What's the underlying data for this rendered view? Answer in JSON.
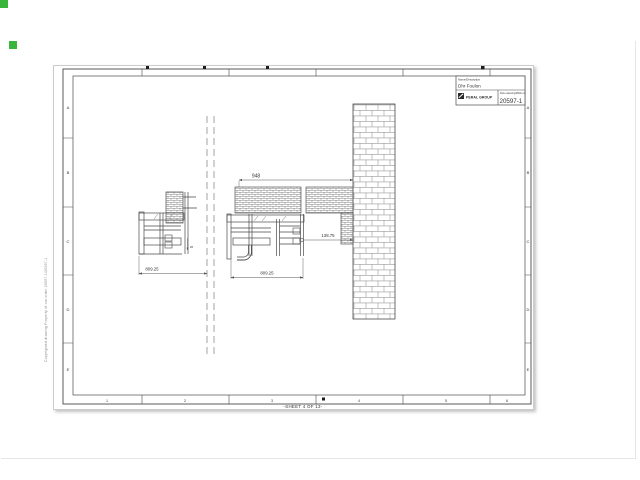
{
  "sheet": {
    "footer_label": "-SHEET 4 OF 13-",
    "side_note": "Copyrighted drawing Property of our order 20597-1/20597-1",
    "grid_rows": [
      "A",
      "B",
      "C",
      "D",
      "E"
    ],
    "grid_cols": [
      "1",
      "2",
      "3",
      "4",
      "5",
      "6"
    ],
    "title_block": {
      "name_label": "Name/Description",
      "name_value": "Dhr Foulon",
      "company_name": "PERAL GROUP",
      "drawing_label": "Deze tekening/DWG no.",
      "drawing_number": "20597-1"
    },
    "dimensions": {
      "overall_width": "948",
      "gap_to_wall": "138.75",
      "center_width": "809.25",
      "left_width": "809.25",
      "small_offset": "26"
    }
  },
  "colors": {
    "marker_green": "#38b53a",
    "frame_line": "#4a4a4a",
    "hatch_line": "#8a8a8a",
    "dimension_line": "#555555",
    "sheet_border": "#cccccc"
  }
}
